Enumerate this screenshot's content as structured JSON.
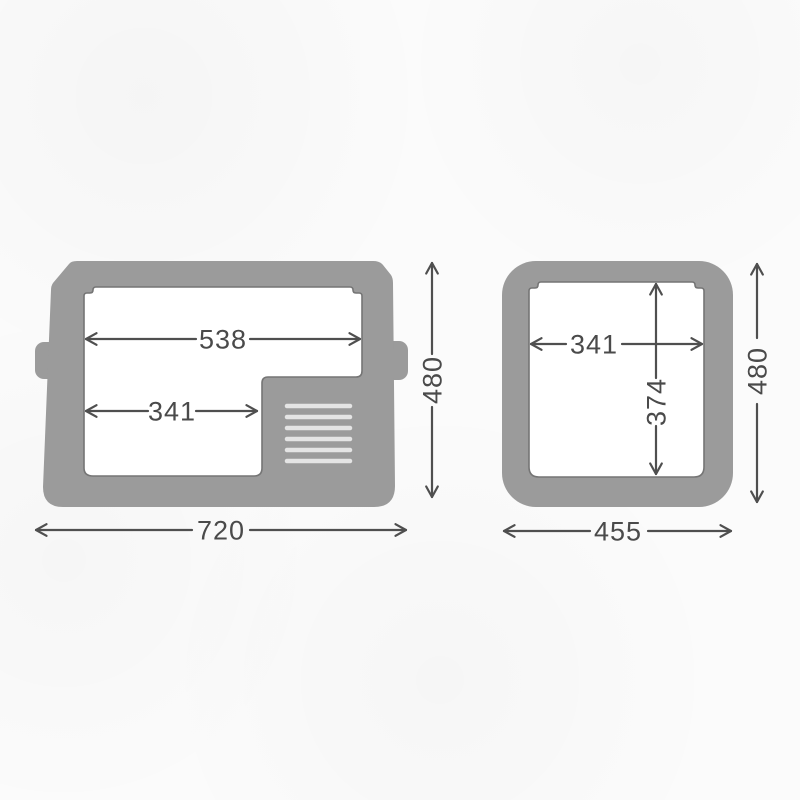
{
  "colors": {
    "body_gray": "#9b9b9b",
    "cavity_white": "#ffffff",
    "cavity_outline": "#757575",
    "vent_slot": "#e4e4e4",
    "dimension_line": "#4f4f4f",
    "dimension_text": "#4a4a4a",
    "background": "#fbfbfb"
  },
  "diagram": {
    "kind": "cooler-dimension-drawing",
    "views": {
      "side": {
        "dims": {
          "inner_top_width": "538",
          "inner_lower_width": "341",
          "overall_height": "480",
          "overall_width": "720"
        }
      },
      "front": {
        "dims": {
          "inner_width": "341",
          "inner_depth": "374",
          "overall_height": "480",
          "overall_width": "455"
        }
      }
    }
  }
}
